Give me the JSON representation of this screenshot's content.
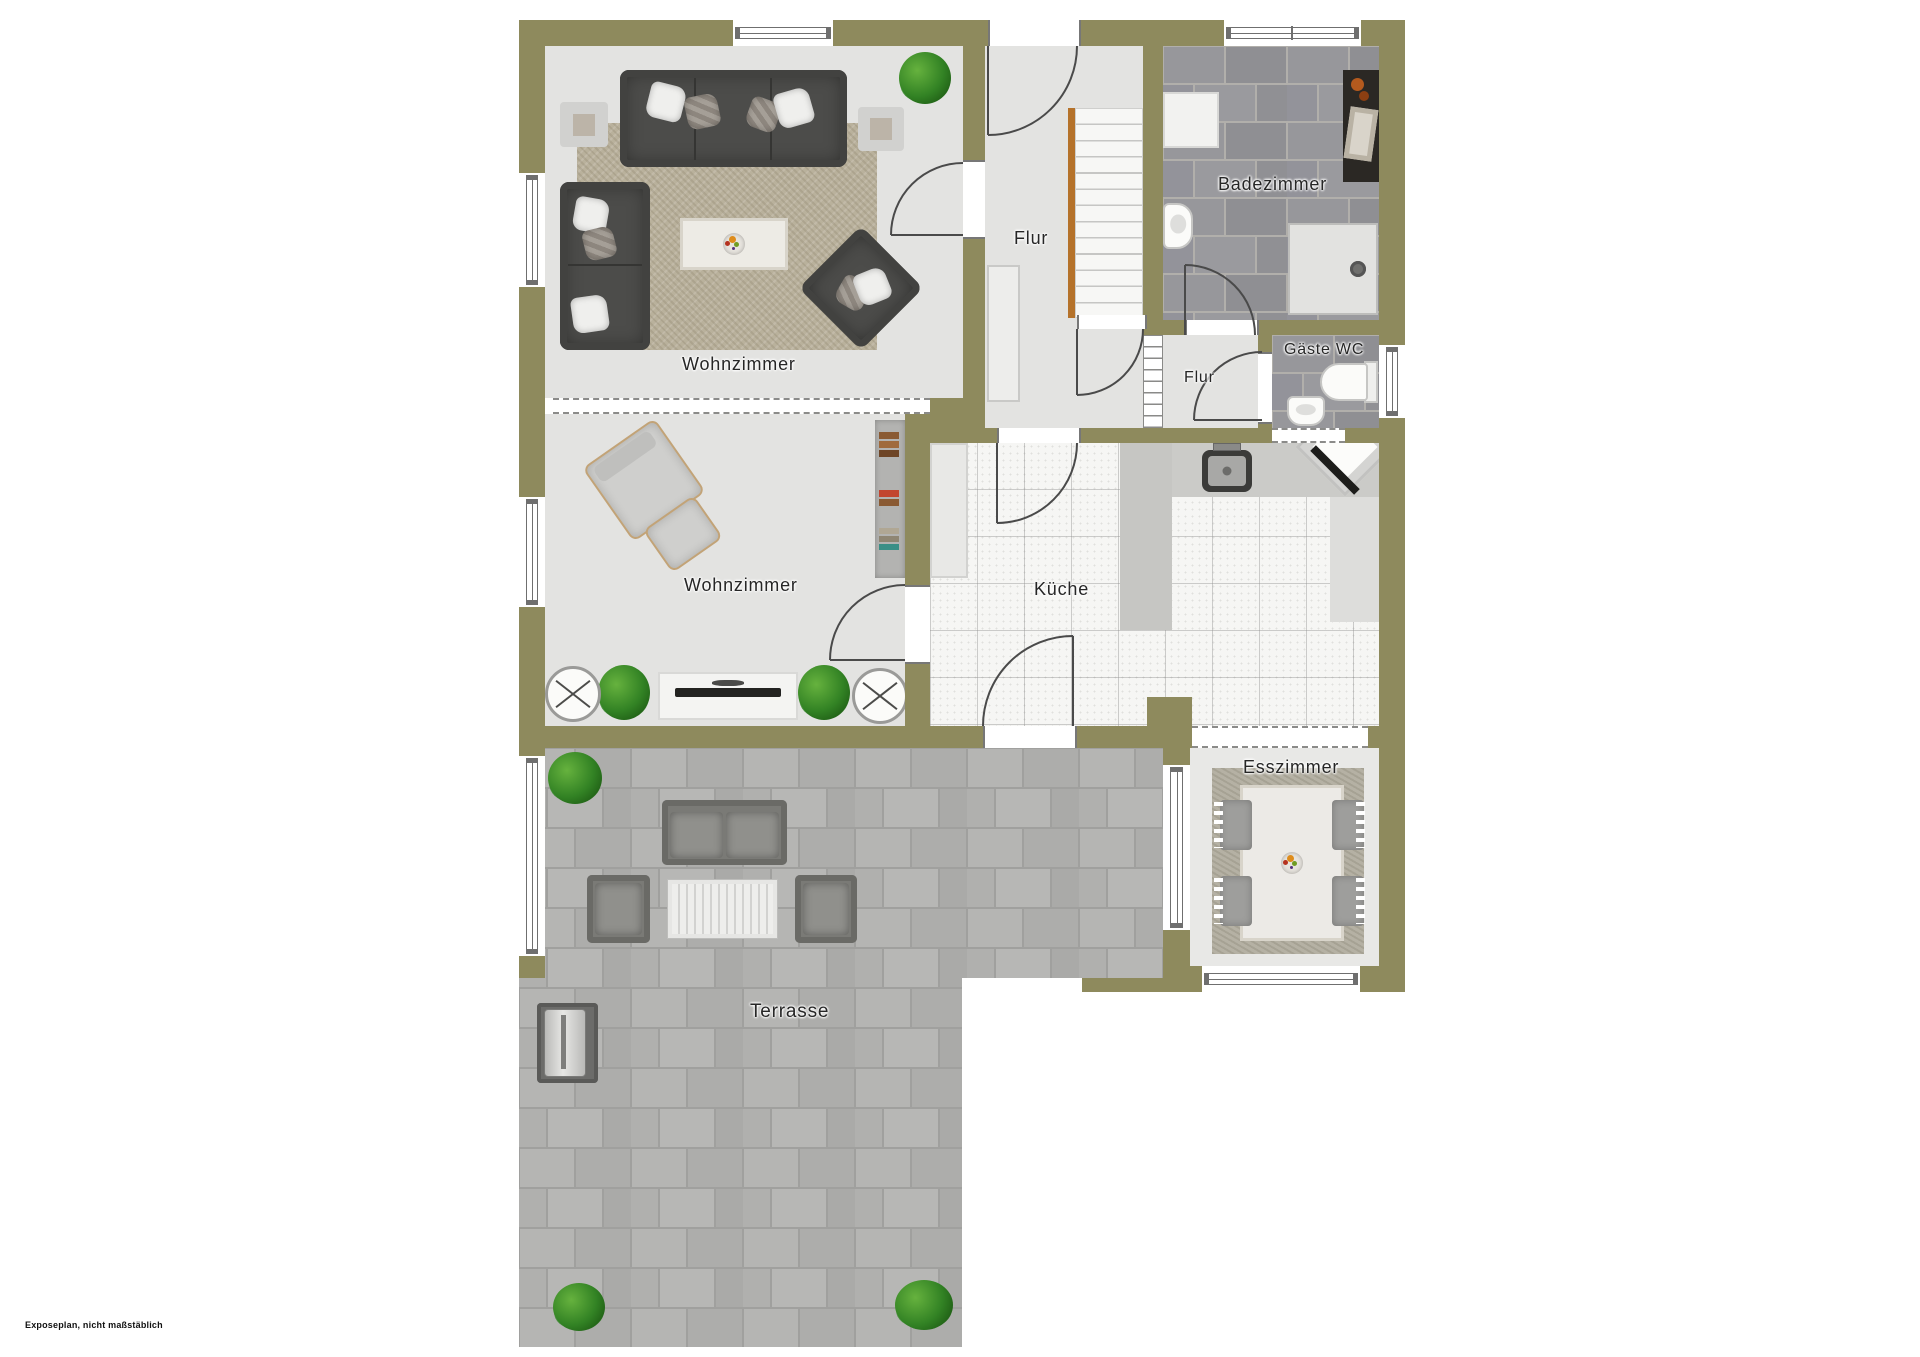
{
  "footer_note": "Exposeplan, nicht maßstäblich",
  "rooms": [
    {
      "id": "wohnzimmer-1",
      "label": "Wohnzimmer"
    },
    {
      "id": "flur-1",
      "label": "Flur"
    },
    {
      "id": "badezimmer",
      "label": "Badezimmer"
    },
    {
      "id": "gaeste-wc",
      "label": "Gäste WC"
    },
    {
      "id": "flur-2",
      "label": "Flur"
    },
    {
      "id": "wohnzimmer-2",
      "label": "Wohnzimmer"
    },
    {
      "id": "kueche",
      "label": "Küche"
    },
    {
      "id": "esszimmer",
      "label": "Esszimmer"
    },
    {
      "id": "terrasse",
      "label": "Terrasse"
    }
  ],
  "colors": {
    "wall": "#8e8a5d",
    "interior_floor": "#e3e3e1",
    "bath_tile": "#96969a",
    "terrace_paver": "#b2b2b0",
    "stair_stringer": "#b5722a",
    "background": "#ffffff"
  }
}
